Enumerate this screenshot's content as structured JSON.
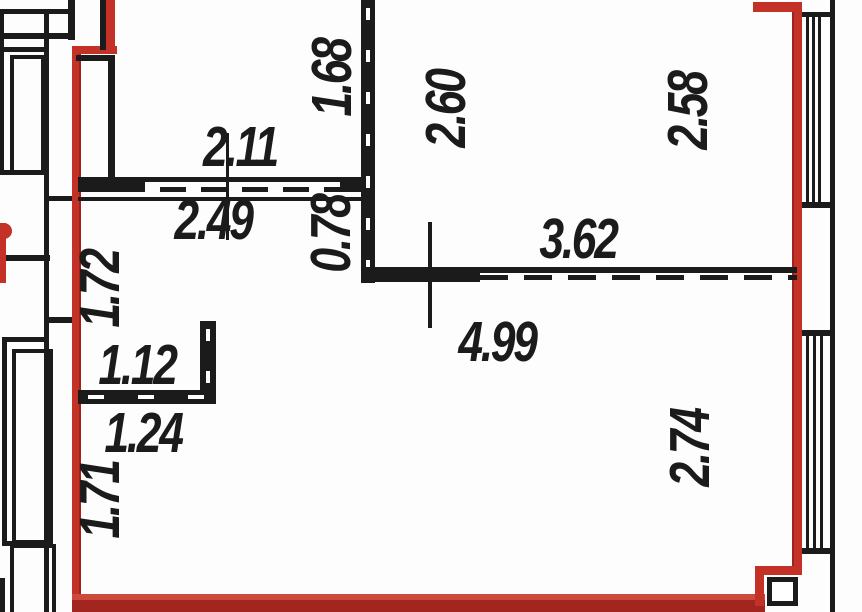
{
  "figure": {
    "kind": "floor-plan"
  },
  "colors": {
    "wall_black": "#1b1b1b",
    "boundary_red": "#c43227",
    "boundary_red_dark": "#a2251f",
    "boundary_red_light": "#cc4a3d",
    "background": "#fdfdfd"
  },
  "dimension_labels": [
    {
      "value": "2.11",
      "x": 240,
      "y": 147,
      "vertical": false
    },
    {
      "value": "2.49",
      "x": 213,
      "y": 220,
      "vertical": false
    },
    {
      "value": "1.68",
      "x": 332,
      "y": 78,
      "vertical": true
    },
    {
      "value": "2.60",
      "x": 446,
      "y": 109,
      "vertical": true
    },
    {
      "value": "2.58",
      "x": 688,
      "y": 111,
      "vertical": true
    },
    {
      "value": "0.78",
      "x": 331,
      "y": 234,
      "vertical": true
    },
    {
      "value": "3.62",
      "x": 578,
      "y": 239,
      "vertical": false
    },
    {
      "value": "4.99",
      "x": 497,
      "y": 342,
      "vertical": false
    },
    {
      "value": "1.72",
      "x": 100,
      "y": 289,
      "vertical": true
    },
    {
      "value": "1.12",
      "x": 137,
      "y": 365,
      "vertical": false
    },
    {
      "value": "1.24",
      "x": 143,
      "y": 433,
      "vertical": false
    },
    {
      "value": "1.71",
      "x": 100,
      "y": 500,
      "vertical": true
    },
    {
      "value": "2.74",
      "x": 690,
      "y": 448,
      "vertical": true
    }
  ]
}
